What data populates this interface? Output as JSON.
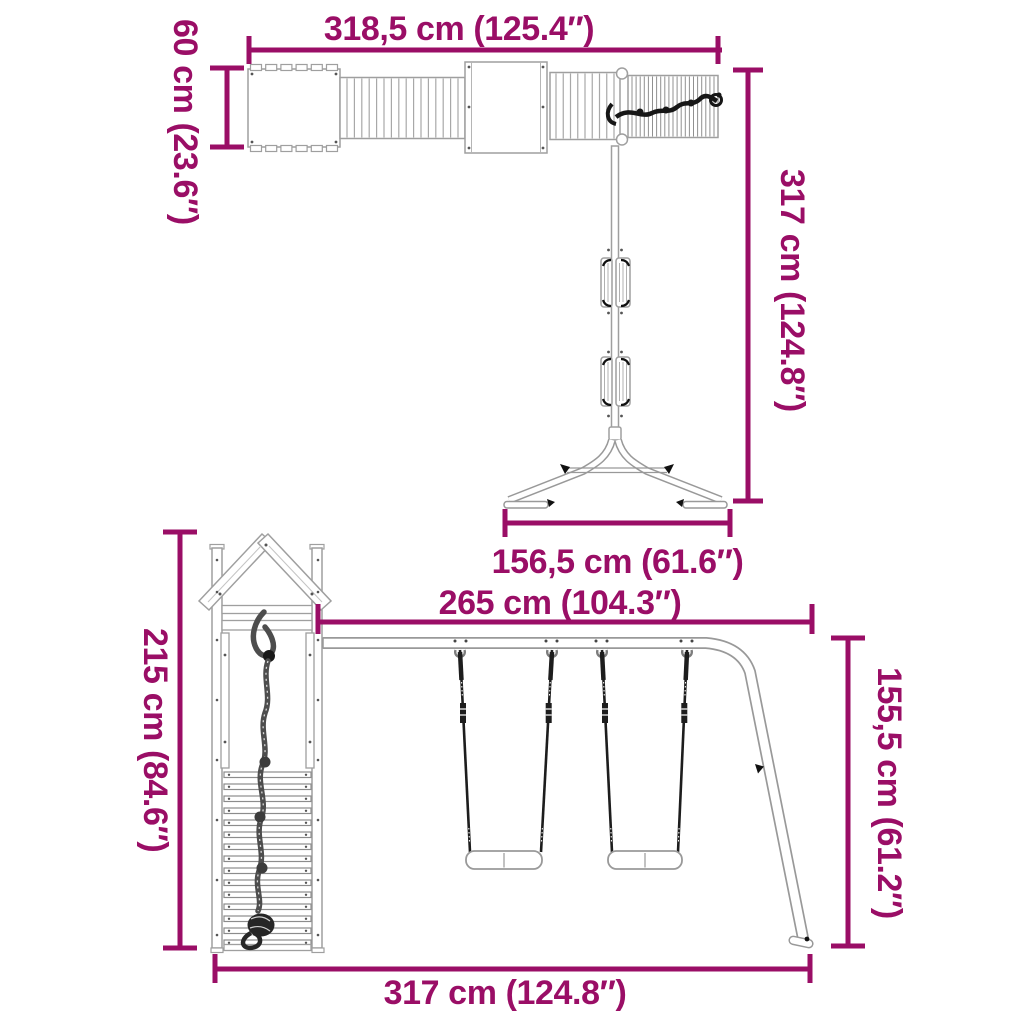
{
  "colors": {
    "dimension": "#9a0e66",
    "outline": "#999999",
    "dark": "#1a1a1a",
    "background": "#ffffff"
  },
  "views": {
    "top": {
      "width_label": "318,5 cm (125.4″)",
      "depth_label": "60 cm (23.6″)",
      "length_label": "317 cm (124.8″)",
      "base_width_label": "156,5 cm (61.6″)"
    },
    "front": {
      "beam_length_label": "265 cm (104.3″)",
      "tower_height_label": "215 cm (84.6″)",
      "frame_height_label": "155,5 cm (61.2″)",
      "total_width_label": "317 cm (124.8″)"
    }
  }
}
